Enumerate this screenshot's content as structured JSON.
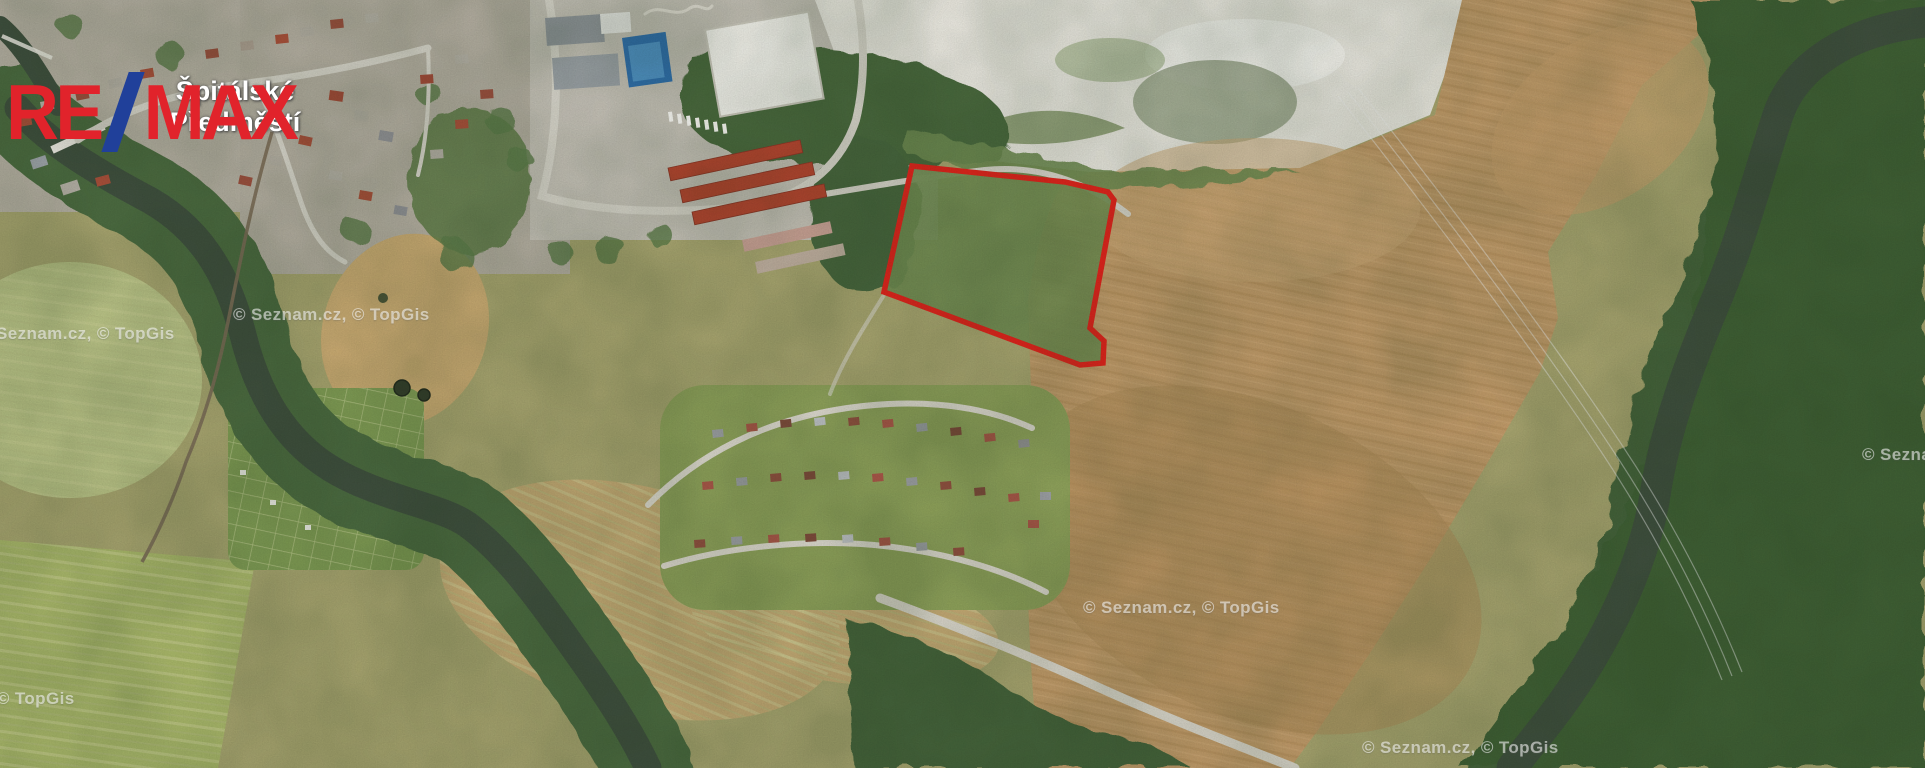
{
  "window": {
    "width": 1925,
    "height": 768,
    "kind": "aerial-map-listing-image"
  },
  "logo": {
    "text_left": "RE",
    "text_right": "MAX",
    "color_red": "#e1232b",
    "color_blue": "#20409a"
  },
  "district_label": {
    "line1": "Špitálské",
    "line2": "Předměstí"
  },
  "attribution": {
    "text": "© Seznam.cz, © TopGis",
    "color": "rgba(255,255,255,0.55)",
    "positions": [
      {
        "x": -22,
        "y": 324
      },
      {
        "x": 233,
        "y": 305
      },
      {
        "x": 1083,
        "y": 598
      },
      {
        "x": -122,
        "y": 689
      },
      {
        "x": 1362,
        "y": 738
      },
      {
        "x": 1862,
        "y": 445
      }
    ]
  },
  "parcel": {
    "points": "912,166 1065,182 1108,192 1114,200 1090,328 1104,341 1103,363 1080,365 884,292",
    "stroke": "#e0231c",
    "stroke_width": "5.5",
    "fill": "#708b51"
  },
  "palette": {
    "field_tan": "#c09a69",
    "forest_green": "#476a3c",
    "water": "#3f4f3e",
    "meadow_olive": "#a7a46f",
    "quarry_white": "#e9e7df",
    "road_gray": "#d6d3c9",
    "town_gray": "#b6b0a3"
  }
}
